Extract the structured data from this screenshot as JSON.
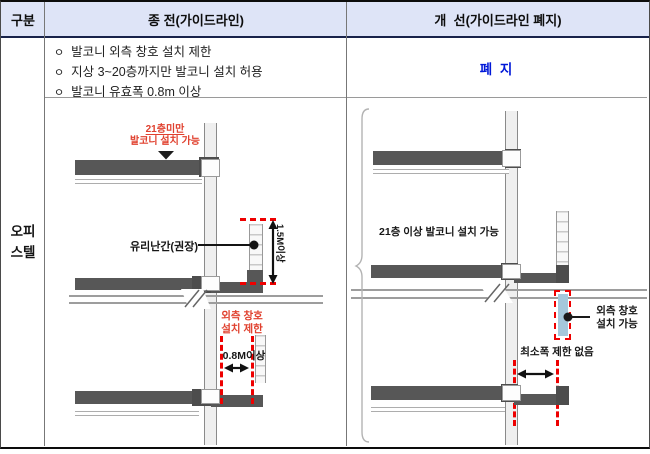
{
  "header": {
    "col_category": "구분",
    "col_before": "종 전(가이드라인)",
    "col_after": "개  선(가이드라인 폐지)"
  },
  "category": {
    "line1": "오피",
    "line2": "스텔"
  },
  "before": {
    "bullets": [
      {
        "marker": "ㅇ",
        "text": "발코니 외측 창호 설치 제한"
      },
      {
        "marker": "ㅇ",
        "text": "지상 3~20층까지만 발코니 설치 허용"
      },
      {
        "marker": "ㅇ",
        "text": "발코니 유효폭 0.8m 이상"
      }
    ],
    "diagram": {
      "floor_note_line1": "21층미만",
      "floor_note_line2": "발코니 설치 가능",
      "railing_label": "유리난간(권장)",
      "height_dim": "1.5M이상",
      "window_note_line1": "외측 창호",
      "window_note_line2": "설치 제한",
      "width_dim": "0.8M이상"
    }
  },
  "after": {
    "status": "폐 지",
    "diagram": {
      "floor_note": "21층 이상 발코니 설치 가능",
      "window_note_line1": "외측 창호",
      "window_note_line2": "설치 가능",
      "width_dim": "최소폭 제한 없음"
    }
  },
  "colors": {
    "header_bg": "#dee4f7",
    "status_blue": "#0018d8",
    "note_red": "#e0402e",
    "dash_red": "#ee0000",
    "slab_gray": "#575757",
    "window_blue": "#a5c8db"
  }
}
